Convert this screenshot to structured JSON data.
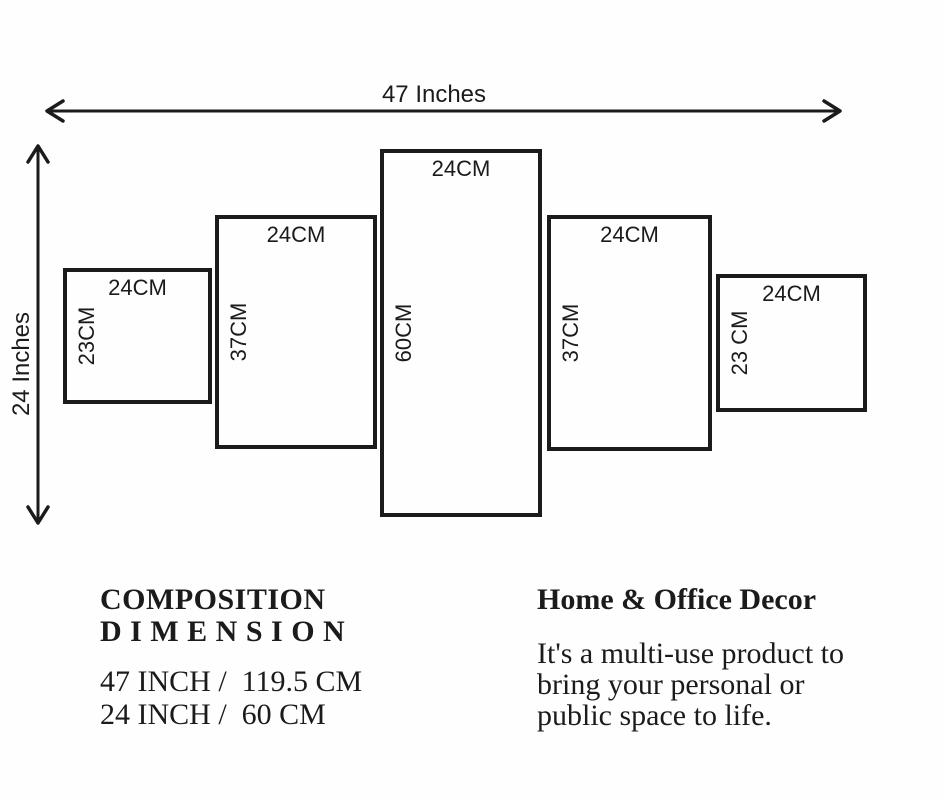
{
  "diagram": {
    "overall_width_label": "47 Inches",
    "overall_height_label": "24 Inches",
    "ink_color": "#1b1b1b",
    "panels": [
      {
        "width_label": "24CM",
        "height_label": "23CM"
      },
      {
        "width_label": "24CM",
        "height_label": "37CM"
      },
      {
        "width_label": "24CM",
        "height_label": "60CM"
      },
      {
        "width_label": "24CM",
        "height_label": "37CM"
      },
      {
        "width_label": "24CM",
        "height_label": "23 CM"
      }
    ]
  },
  "composition": {
    "title_line1": "COMPOSITION",
    "title_line2": "D I M E N S I O N",
    "dimension_line1": "47 INCH /  119.5 CM",
    "dimension_line2": "24 INCH /  60 CM"
  },
  "decor": {
    "title": "Home & Office Decor",
    "description_line1": "It's a multi-use product to",
    "description_line2": "bring your personal or",
    "description_line3": "public space to life."
  }
}
